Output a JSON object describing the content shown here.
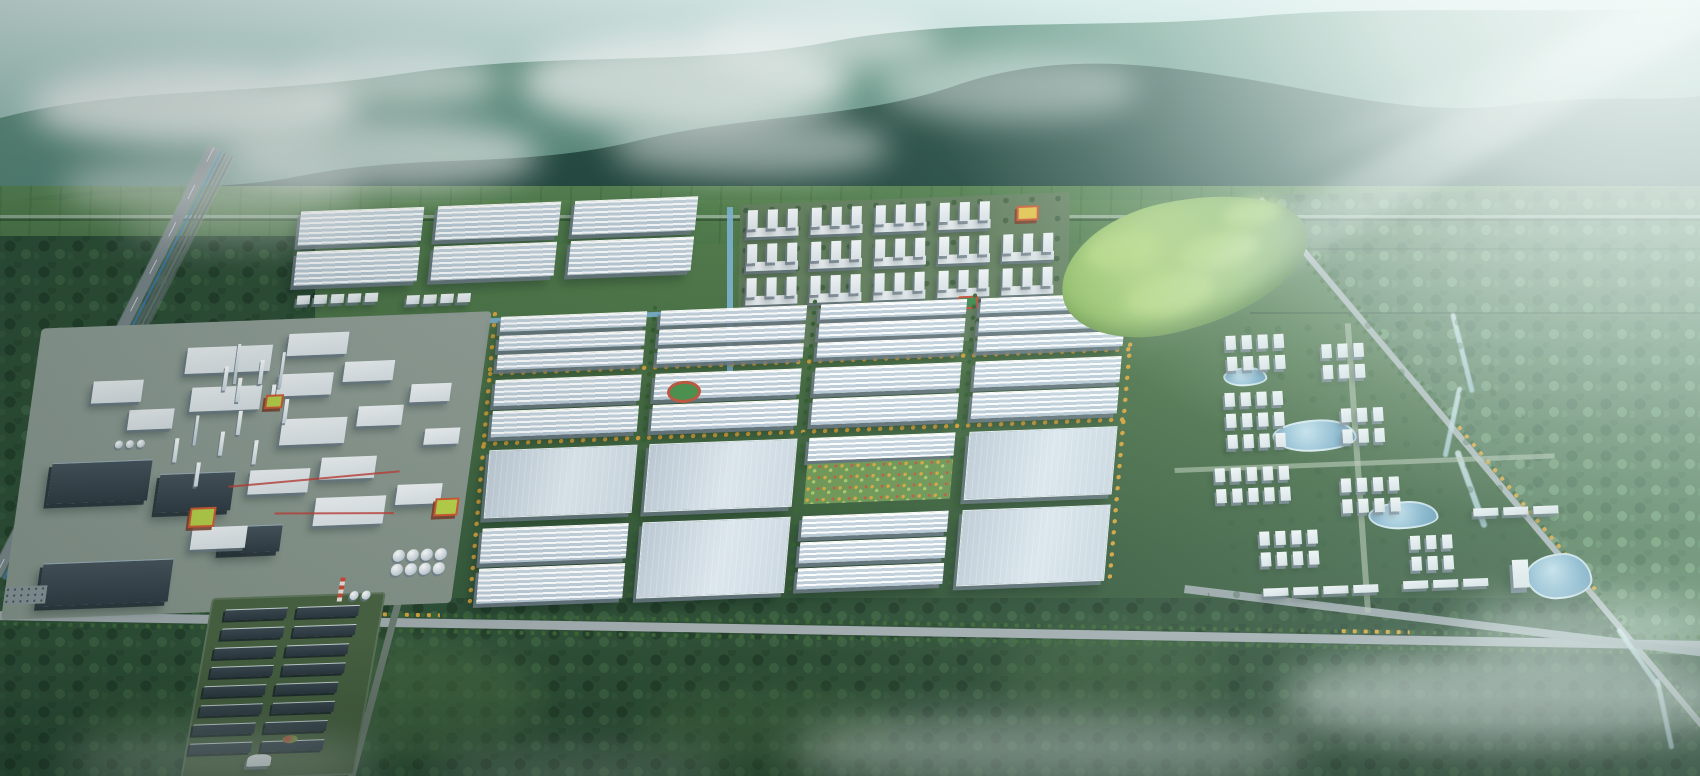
{
  "scene": {
    "description": "Aerial bird's-eye rendering of a large green industrial park campus at the foot of misty forested mountains, with warehouses, a chemical plant, dormitories, an eco-residential district, tree-lined avenues, a rail corridor and sun glare from the upper right",
    "width": 1700,
    "height": 776
  },
  "palette": {
    "sky_top": "#d8ecea",
    "sky_mid": "#9cc3ba",
    "haze_white": "#f2fbfa",
    "mountain_far_top": "#6e9d8c",
    "mountain_far_bot": "#44756a",
    "mountain_near_top": "#2c5348",
    "mountain_near_bot": "#1d4038",
    "hills_lit": "#57895f",
    "foothill": "#47744d",
    "field_green": "#5d8954",
    "valley_green": "#4b7147",
    "forest_dark": "#2f5037",
    "forest_light": "#547a58",
    "lawn": "#8fb368",
    "golf_light": "#b2d57e",
    "road_gray": "#a2acaf",
    "rail_gray": "#5d686e",
    "pipeline_blue": "#3a7fc2",
    "roof_white": "#f8fbfd",
    "roof_flat": "#ccd8e1",
    "roof_dark": "#39434b",
    "wall_white": "#eef2f5",
    "wall_shadow": "#6c7a86",
    "accent_orange": "#d05a36",
    "accent_lime": "#b9d24a",
    "accent_red": "#c4503a",
    "tree_green": "#3c6637",
    "tree_gold": "#d7a33b",
    "canal_blue": "#7fb6d6",
    "pond_blue": "#7fb0cc",
    "river_blue": "#c6dfe6",
    "mist_white": "#eef7f5"
  },
  "landscape": {
    "clouds": [
      {
        "x": 30,
        "y": 64,
        "w": 330,
        "h": 84,
        "o": 0.8
      },
      {
        "x": 220,
        "y": 118,
        "w": 320,
        "h": 74,
        "o": 0.62
      },
      {
        "x": 60,
        "y": 158,
        "w": 300,
        "h": 56,
        "o": 0.5
      },
      {
        "x": 520,
        "y": 34,
        "w": 330,
        "h": 96,
        "o": 0.72
      },
      {
        "x": 610,
        "y": 116,
        "w": 280,
        "h": 62,
        "o": 0.5
      },
      {
        "x": 880,
        "y": 52,
        "w": 260,
        "h": 70,
        "o": 0.45
      },
      {
        "x": 290,
        "y": 52,
        "w": 210,
        "h": 56,
        "o": 0.6
      },
      {
        "x": 700,
        "y": 10,
        "w": 240,
        "h": 60,
        "o": 0.55
      },
      {
        "x": 120,
        "y": 208,
        "w": 260,
        "h": 40,
        "o": 0.3
      }
    ],
    "mists": [
      {
        "x": 790,
        "y": 716,
        "w": 520,
        "h": 74,
        "o": 0.5
      },
      {
        "x": 1280,
        "y": 652,
        "w": 460,
        "h": 94,
        "o": 0.62
      },
      {
        "x": 1460,
        "y": 596,
        "w": 260,
        "h": 64,
        "o": 0.45
      },
      {
        "x": 60,
        "y": 736,
        "w": 320,
        "h": 56,
        "o": 0.32
      },
      {
        "x": 430,
        "y": 750,
        "w": 300,
        "h": 44,
        "o": 0.25
      }
    ],
    "glades": [
      {
        "x": 240,
        "y": 640,
        "w": 300,
        "h": 120,
        "o": 0.55
      },
      {
        "x": 640,
        "y": 690,
        "w": 260,
        "h": 80,
        "o": 0.45
      },
      {
        "x": 1000,
        "y": 630,
        "w": 220,
        "h": 90,
        "o": 0.4
      },
      {
        "x": 80,
        "y": 700,
        "w": 200,
        "h": 60,
        "o": 0.35
      },
      {
        "x": 40,
        "y": 420,
        "w": 160,
        "h": 130,
        "o": 0.4
      }
    ],
    "hedgerows": [
      {
        "x": 1250,
        "y": 248,
        "w": 450,
        "o": 0.25
      },
      {
        "x": 1250,
        "y": 312,
        "w": 450,
        "o": 0.35
      }
    ]
  },
  "infrastructure": {
    "foothill_road_y": 215,
    "railway": {
      "x": 235,
      "y": 158,
      "angle": 117,
      "length": 480
    },
    "boulevard": {
      "x": -10,
      "y": 604,
      "angle": 1,
      "length": 1725,
      "gold_segments": [
        {
          "x": 380,
          "w": 70
        },
        {
          "x": 1350,
          "w": 70
        }
      ]
    },
    "east_road": {
      "x": 1267,
      "y": 193,
      "angle": 50,
      "length": 700,
      "gold_segment": {
        "x": 300,
        "w": 220
      }
    },
    "se_road": {
      "x": 1185,
      "y": 585,
      "angle": 7,
      "length": 530
    },
    "access_road": {
      "x": 402,
      "y": 602,
      "angle": 105,
      "length": 200
    },
    "river_segments": [
      {
        "x": 1460,
        "y": 312,
        "w": 5,
        "h": 82,
        "r": -14
      },
      {
        "x": 1450,
        "y": 386,
        "w": 5,
        "h": 72,
        "r": 12
      },
      {
        "x": 1468,
        "y": 448,
        "w": 6,
        "h": 82,
        "r": -20
      },
      {
        "x": 1636,
        "y": 622,
        "w": 5,
        "h": 72,
        "r": -35
      },
      {
        "x": 1662,
        "y": 678,
        "w": 5,
        "h": 72,
        "r": -12
      }
    ],
    "canal_h": {
      "x": 235,
      "y": 102,
      "w": 440,
      "h": 5
    },
    "canal_v": {
      "x": 672,
      "y": 0,
      "w": 6,
      "h": 165
    }
  },
  "park": {
    "origin": {
      "left": 55,
      "top": 233,
      "width": 1460,
      "height": 420,
      "skew_y_deg": -2.2
    },
    "nw_factories": {
      "skew_x_deg": -6,
      "cols_x": [
        245,
        382,
        519
      ],
      "col_w": 127,
      "rows_y": [
        -12,
        28
      ],
      "row_h": 35,
      "small_clusters": [
        {
          "x": 250,
          "y": 72,
          "n": 5
        },
        {
          "x": 360,
          "y": 76,
          "n": 4
        }
      ]
    },
    "dormitories": {
      "skew_x_deg": -1,
      "base": {
        "x": 685,
        "y": -2,
        "w": 330,
        "h": 145
      },
      "cols_x": [
        692,
        756,
        820,
        884,
        948
      ],
      "rows_y": [
        4,
        38,
        72
      ],
      "slab_w": 52,
      "block_h": 27,
      "wing_dx": [
        1,
        21,
        41
      ],
      "accent": {
        "col": 4,
        "row": 0
      },
      "court": {
        "x": 905,
        "y": 98,
        "w": 16,
        "h": 9
      }
    },
    "central_grid": {
      "skew_x_deg": -5,
      "x0": 455,
      "y0": 100,
      "col_w": 150,
      "road_w": 10,
      "cols": 4,
      "row_heights": [
        54,
        62,
        70,
        78
      ],
      "road_h": 8,
      "row_patterns": [
        "narrow3",
        "hall2",
        "flat1",
        "mixed"
      ],
      "garden_cell": {
        "col": 2,
        "row": 2
      },
      "gold_h_roads": [
        1,
        2
      ],
      "gold_v_edges": true
    },
    "chemical_plant": {
      "skew_x_deg": -8,
      "pad": {
        "x": 0,
        "y": 95,
        "w": 450,
        "h": 290
      },
      "dark_halls": [
        {
          "x": 30,
          "y": 230,
          "w": 100,
          "h": 40
        },
        {
          "x": 140,
          "y": 245,
          "w": 75,
          "h": 38
        },
        {
          "x": 35,
          "y": 330,
          "w": 130,
          "h": 42
        },
        {
          "x": 210,
          "y": 300,
          "w": 60,
          "h": 26
        }
      ],
      "white_halls": [
        {
          "x": 150,
          "y": 120,
          "w": 85,
          "h": 26
        },
        {
          "x": 250,
          "y": 110,
          "w": 60,
          "h": 22
        },
        {
          "x": 160,
          "y": 160,
          "w": 70,
          "h": 24
        },
        {
          "x": 245,
          "y": 150,
          "w": 55,
          "h": 22
        },
        {
          "x": 310,
          "y": 140,
          "w": 50,
          "h": 20
        },
        {
          "x": 255,
          "y": 195,
          "w": 65,
          "h": 26
        },
        {
          "x": 330,
          "y": 185,
          "w": 45,
          "h": 20
        },
        {
          "x": 230,
          "y": 245,
          "w": 60,
          "h": 24
        },
        {
          "x": 300,
          "y": 235,
          "w": 55,
          "h": 22
        },
        {
          "x": 300,
          "y": 275,
          "w": 70,
          "h": 28
        },
        {
          "x": 380,
          "y": 265,
          "w": 45,
          "h": 20
        },
        {
          "x": 180,
          "y": 300,
          "w": 55,
          "h": 22
        },
        {
          "x": 380,
          "y": 165,
          "w": 40,
          "h": 18
        },
        {
          "x": 400,
          "y": 210,
          "w": 35,
          "h": 16
        },
        {
          "x": 100,
          "y": 180,
          "w": 45,
          "h": 20
        },
        {
          "x": 60,
          "y": 150,
          "w": 50,
          "h": 22
        }
      ],
      "towers": [
        {
          "x": 190,
          "y": 140
        },
        {
          "x": 205,
          "y": 152
        },
        {
          "x": 225,
          "y": 135
        },
        {
          "x": 240,
          "y": 160
        },
        {
          "x": 210,
          "y": 185
        },
        {
          "x": 195,
          "y": 205
        },
        {
          "x": 255,
          "y": 175
        },
        {
          "x": 150,
          "y": 210
        },
        {
          "x": 230,
          "y": 215
        },
        {
          "x": 175,
          "y": 235
        }
      ],
      "stacks": [
        {
          "x": 200,
          "y": 118,
          "h": 40
        },
        {
          "x": 246,
          "y": 128,
          "h": 36
        },
        {
          "x": 168,
          "y": 188,
          "h": 30
        }
      ],
      "tank_farm": {
        "x": 385,
        "y": 330,
        "rows": 2,
        "cols": 4,
        "d": 12,
        "gap": 14
      },
      "tank_small": {
        "x": 90,
        "y": 210,
        "rows": 1,
        "cols": 3,
        "d": 8,
        "gap": 11
      },
      "orange_buildings": [
        {
          "x": 175,
          "y": 280,
          "w": 26,
          "h": 20
        },
        {
          "x": 235,
          "y": 170,
          "w": 18,
          "h": 14
        },
        {
          "x": 420,
          "y": 280,
          "w": 24,
          "h": 18
        }
      ],
      "pipe_lines": [
        {
          "x": 210,
          "y": 255,
          "w": 170,
          "r": -3
        },
        {
          "x": 260,
          "y": 290,
          "w": 120,
          "r": 2
        }
      ],
      "parking": {
        "x": 0,
        "y": 352,
        "w": 42,
        "h": 18
      }
    },
    "sports_field": {
      "x": 612,
      "y": 172,
      "w": 28,
      "h": 16
    },
    "golf_park": {
      "x": 1005,
      "y": 10,
      "w": 250,
      "h": 130,
      "rotate": -10,
      "mounds": [
        {
          "x": 30,
          "y": 20,
          "w": 70,
          "h": 34
        },
        {
          "x": 120,
          "y": 40,
          "w": 80,
          "h": 36
        },
        {
          "x": 60,
          "y": 70,
          "w": 90,
          "h": 40
        },
        {
          "x": 170,
          "y": 14,
          "w": 60,
          "h": 28
        }
      ]
    },
    "residential": {
      "skew_x_deg": 4,
      "base": {
        "x": 1085,
        "y": 135,
        "w": 430,
        "h": 300
      },
      "clip": "polygon(20% 0%, 76% 0%, 100% 90%, 8% 100%)",
      "tower_clusters": [
        {
          "x": 1160,
          "y": 148,
          "cols": 4,
          "rows": 2
        },
        {
          "x": 1255,
          "y": 160,
          "cols": 3,
          "rows": 2
        },
        {
          "x": 1155,
          "y": 205,
          "cols": 4,
          "rows": 3
        },
        {
          "x": 1270,
          "y": 225,
          "cols": 3,
          "rows": 2
        },
        {
          "x": 1140,
          "y": 280,
          "cols": 5,
          "rows": 2
        },
        {
          "x": 1265,
          "y": 295,
          "cols": 4,
          "rows": 2
        },
        {
          "x": 1180,
          "y": 345,
          "cols": 4,
          "rows": 2
        },
        {
          "x": 1330,
          "y": 355,
          "cols": 3,
          "rows": 2
        }
      ],
      "slab_rows": [
        {
          "x": 1395,
          "y": 330,
          "n": 3
        },
        {
          "x": 1320,
          "y": 400,
          "n": 3
        },
        {
          "x": 1180,
          "y": 402,
          "n": 4
        }
      ],
      "office_tower": {
        "x": 1430,
        "y": 383,
        "w": 16,
        "h": 28
      },
      "ponds": [
        {
          "x": 1200,
          "y": 235,
          "w": 80,
          "h": 28
        },
        {
          "x": 1290,
          "y": 320,
          "w": 66,
          "h": 24
        },
        {
          "x": 1155,
          "y": 180,
          "w": 40,
          "h": 15
        },
        {
          "x": 1443,
          "y": 378,
          "w": 62,
          "h": 42
        }
      ],
      "paths": [
        {
          "x": 1280,
          "y": 140,
          "w": 6,
          "h": 290,
          "v": true
        },
        {
          "x": 1100,
          "y": 278,
          "w": 380,
          "h": 5,
          "v": false
        }
      ]
    }
  },
  "south_facility": {
    "origin": {
      "left": 212,
      "top": 598,
      "width": 170,
      "height": 178,
      "skew_x_deg": -10,
      "skew_y_deg": -2
    },
    "ground": "#4a6342",
    "shed_rows": [
      {
        "y": 6,
        "xs": [
          8,
          80
        ]
      },
      {
        "y": 25,
        "xs": [
          8,
          80
        ]
      },
      {
        "y": 44,
        "xs": [
          4,
          76
        ]
      },
      {
        "y": 63,
        "xs": [
          4,
          76
        ]
      },
      {
        "y": 82,
        "xs": [
          0,
          72
        ]
      },
      {
        "y": 101,
        "xs": [
          0,
          72
        ]
      },
      {
        "y": 120,
        "xs": [
          -4,
          68
        ]
      },
      {
        "y": 139,
        "xs": [
          -4,
          68
        ]
      }
    ],
    "shed": {
      "w": 62,
      "h": 10
    },
    "chimney": {
      "x": 126,
      "y": -16,
      "w": 5,
      "h": 24
    },
    "tanks": {
      "x": 138,
      "y": -2,
      "n": 2,
      "d": 9
    },
    "tent": {
      "x": 64,
      "y": 158,
      "w": 24,
      "h": 12
    },
    "flowers": {
      "x": 96,
      "y": 140,
      "w": 15,
      "h": 8
    }
  },
  "inventory": {
    "central_grid_blocks": 16,
    "nw_factory_halls": 6,
    "dormitory_blocks": 15,
    "residential_tower_clusters": 8,
    "ponds": 4,
    "storage_tanks": 11,
    "process_towers": 10,
    "chimneys": 3,
    "dark_sheds": 16,
    "orange_accent_buildings": 4
  }
}
